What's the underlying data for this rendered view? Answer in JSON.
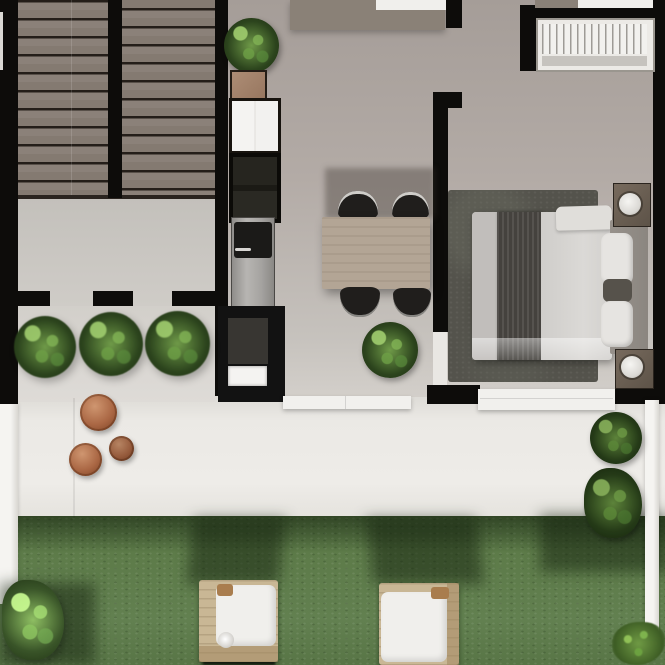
{
  "scene": {
    "title": "Studio apartment floor plan – photorealistic top-down render",
    "view": "top-down",
    "areas": [
      "staircase",
      "kitchen",
      "dining-area",
      "bedroom",
      "terrace",
      "garden"
    ]
  },
  "palette": {
    "wall": "#0d0c0a",
    "stairTread": "#8b8179",
    "stairGap": "#241e19",
    "hallFloor": "#b3aba6",
    "landingFloor": "#cfccc7",
    "patioFloor": "#d8d5d1",
    "counter": "#8a8177",
    "terrace": "#ebe9e5",
    "fence": "#f3f2ef",
    "grass": "#5d7b49",
    "grassShadow": "#12200c",
    "rug": "#54534c",
    "mattress": "#c9c6c3",
    "blanket": "#45423e",
    "duvet": "#d5d3d0",
    "pillow": "#e6e4e1",
    "headboard": "#8f8a84",
    "nightstand": "#6a5f54",
    "lamp": "#efedea",
    "tableWood": "#b3a595",
    "chair": "#201e1c",
    "chairTrim": "#cfcdc9",
    "cabinetWhite": "#f2f1ef",
    "cabinetGlass": "#191813",
    "fridge": "#a5a3a0",
    "fridgePanel": "#1b1a18",
    "island": "#121212",
    "sink": "#f4f3f1",
    "woodBox": "#a3826c",
    "plantDark": "#2c441d",
    "plantLight": "#6f9a48",
    "terracotta": "#aa6744",
    "loungerWood": "#c9b795",
    "cushion": "#f0efec",
    "windowFrame": "#eceae6",
    "windowSlat": "#9e9b96",
    "mat": "#f1f0ed"
  },
  "objects": {
    "staircase": {
      "label": "double-flight staircase",
      "flights": 2,
      "treads_per_flight": 11
    },
    "kitchen": {
      "items": [
        "potted-plant",
        "wood-crate",
        "white-wall-cabinet",
        "glass-front-cabinet",
        "refrigerator",
        "kitchen-island",
        "sink"
      ]
    },
    "dining": {
      "items": [
        "wood-dining-table",
        "chair",
        "chair",
        "chair",
        "chair",
        "potted-plant"
      ]
    },
    "bedroom": {
      "items": [
        "area-rug",
        "double-bed",
        "throw-blanket",
        "duvet",
        "pillow",
        "pillow",
        "accent-pillow",
        "headboard",
        "nightstand",
        "table-lamp",
        "nightstand",
        "table-lamp",
        "louvered-window",
        "door-mat"
      ]
    },
    "hall": {
      "items": [
        "potted-plant",
        "potted-plant",
        "potted-plant",
        "door-openings"
      ]
    },
    "terrace": {
      "items": [
        "terracotta-stool-large",
        "terracotta-stool-medium",
        "terracotta-stool-small",
        "white-fence",
        "shrub",
        "shrub"
      ]
    },
    "garden": {
      "items": [
        "lawn",
        "sun-lounger-left",
        "sun-lounger-right",
        "lounger-shadow",
        "lounger-shadow",
        "bush-cluster",
        "grass-tuft"
      ]
    }
  }
}
